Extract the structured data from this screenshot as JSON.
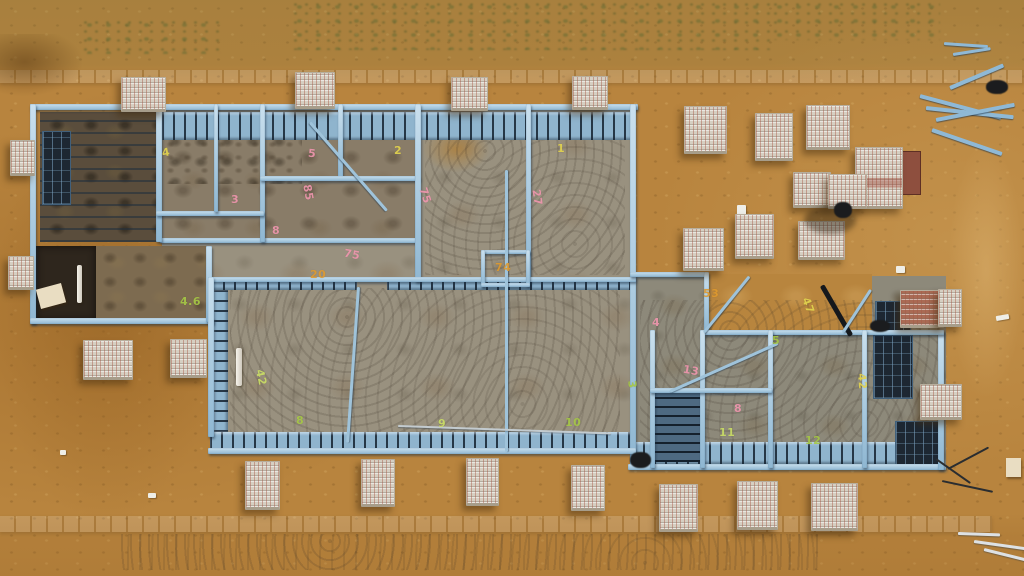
{
  "image": {
    "description": "Aerial drone photo of a residential light-gauge steel house frame erected on a concrete slab, surrounded by orange sand, brick pallets and building materials",
    "width": 1024,
    "height": 576
  },
  "palette": {
    "sand": "#b8843e",
    "kerb": "#d9be8a",
    "slab": "#99917f",
    "steel_light": "#cae0ee",
    "steel_mid": "#8fb7d2",
    "steel_dark": "#1d2732",
    "yellow": "#e3d44e",
    "pink": "#ef96ae",
    "orange": "#df9a2f",
    "green": "#a6c845",
    "lime": "#cbde66"
  },
  "scene": {
    "elements": [
      [
        "strip",
        0,
        70,
        1024,
        13,
        0,
        "kerb-strip-top"
      ],
      [
        "strip",
        0,
        516,
        992,
        16,
        0,
        "kerb-strip-bottom"
      ],
      [
        "weeds",
        290,
        0,
        480,
        50,
        0,
        "weed-patch"
      ],
      [
        "weeds",
        770,
        0,
        170,
        40,
        0,
        "weed-patch"
      ],
      [
        "weeds",
        80,
        18,
        140,
        36,
        0,
        "weed-patch"
      ],
      [
        "wetpatch",
        0,
        34,
        82,
        62,
        0,
        "wet-sand-patch"
      ],
      [
        "sand-shade",
        0,
        96,
        215,
        420,
        0,
        "sand-shade"
      ],
      [
        "sand-light",
        948,
        140,
        76,
        260,
        0,
        "sand-highlight"
      ],
      [
        "dirt-dark",
        40,
        112,
        118,
        130,
        0,
        "left-section-floor"
      ],
      [
        "slab-dirty",
        162,
        108,
        253,
        132,
        0,
        "concrete-slab"
      ],
      [
        "mottle",
        162,
        112,
        140,
        72,
        0,
        "dirt-mottle"
      ],
      [
        "slab",
        417,
        110,
        109,
        170,
        0,
        "concrete-slab"
      ],
      [
        "slab",
        530,
        110,
        102,
        170,
        0,
        "concrete-slab"
      ],
      [
        "slab",
        162,
        240,
        255,
        40,
        0,
        "concrete-slab"
      ],
      [
        "slab",
        212,
        282,
        420,
        156,
        0,
        "concrete-slab"
      ],
      [
        "slab-green",
        634,
        276,
        312,
        192,
        0,
        "concrete-slab"
      ],
      [
        "sandpatch",
        706,
        274,
        166,
        56,
        0,
        "sand-patch"
      ],
      [
        "dirt",
        95,
        246,
        114,
        74,
        0,
        "dirt-floor"
      ],
      [
        "dark-room",
        36,
        246,
        60,
        74,
        0,
        "dark-room-interior"
      ],
      [
        "sandblob",
        423,
        126,
        66,
        46,
        0,
        "sand-patch"
      ],
      [
        "track",
        230,
        288,
        390,
        145,
        0,
        "tyre-tracks"
      ],
      [
        "track",
        640,
        300,
        300,
        155,
        0,
        "tyre-tracks"
      ],
      [
        "track",
        425,
        120,
        200,
        155,
        0,
        "tyre-tracks"
      ],
      [
        "track",
        120,
        534,
        700,
        36,
        0,
        "tyre-tracks"
      ],
      [
        "joist-rows",
        40,
        112,
        118,
        130,
        0,
        "ceiling-joists"
      ],
      [
        "truss-h",
        162,
        112,
        470,
        28,
        0,
        "floor-joist-band"
      ],
      [
        "truss-h",
        212,
        277,
        145,
        13,
        0,
        "floor-joist-band"
      ],
      [
        "truss-h",
        387,
        277,
        249,
        13,
        0,
        "floor-joist-band"
      ],
      [
        "truss-h",
        210,
        432,
        424,
        20,
        0,
        "floor-joist-band"
      ],
      [
        "truss-h",
        632,
        442,
        308,
        22,
        0,
        "floor-joist-band"
      ],
      [
        "truss-v",
        212,
        290,
        16,
        142,
        0,
        "stud-band"
      ],
      [
        "truss-v-dark",
        652,
        392,
        48,
        70,
        0,
        "stud-bay"
      ],
      [
        "grid-dark",
        874,
        336,
        38,
        62,
        0,
        "dark-framing-bay"
      ],
      [
        "grid-dark",
        896,
        422,
        44,
        44,
        0,
        "dark-framing-bay"
      ],
      [
        "grid-dark",
        876,
        302,
        34,
        32,
        0,
        "dark-framing-bay"
      ],
      [
        "grid-dark",
        43,
        132,
        27,
        72,
        0,
        "window-frame"
      ],
      [
        "wall",
        30,
        104,
        608,
        6,
        0,
        "steel-frame-wall"
      ],
      [
        "wall",
        30,
        104,
        6,
        220,
        0,
        "steel-frame-wall"
      ],
      [
        "wall",
        30,
        318,
        184,
        6,
        0,
        "steel-frame-wall"
      ],
      [
        "wall",
        206,
        246,
        6,
        76,
        0,
        "steel-frame-wall"
      ],
      [
        "wall",
        160,
        238,
        258,
        5,
        0,
        "steel-frame-wall"
      ],
      [
        "wall",
        156,
        104,
        6,
        138,
        0,
        "steel-frame-wall"
      ],
      [
        "wall",
        260,
        104,
        5,
        138,
        0,
        "steel-frame-wall"
      ],
      [
        "wall",
        338,
        104,
        5,
        74,
        0,
        "steel-frame-wall"
      ],
      [
        "wall",
        260,
        176,
        160,
        5,
        0,
        "steel-frame-wall"
      ],
      [
        "wall",
        156,
        211,
        108,
        5,
        0,
        "steel-frame-wall"
      ],
      [
        "wall",
        214,
        104,
        4,
        108,
        0,
        "steel-frame-wall"
      ],
      [
        "wall",
        415,
        104,
        6,
        178,
        0,
        "steel-frame-wall"
      ],
      [
        "wall",
        526,
        104,
        5,
        178,
        0,
        "steel-frame-wall"
      ],
      [
        "wall",
        630,
        104,
        6,
        362,
        0,
        "steel-frame-wall"
      ],
      [
        "wall",
        212,
        277,
        424,
        5,
        0,
        "steel-frame-wall"
      ],
      [
        "wall",
        481,
        250,
        49,
        4,
        0,
        "closet-box-wall"
      ],
      [
        "wall",
        481,
        250,
        4,
        36,
        0,
        "closet-box-wall"
      ],
      [
        "wall",
        526,
        250,
        4,
        36,
        0,
        "closet-box-wall"
      ],
      [
        "wall",
        481,
        283,
        49,
        4,
        0,
        "closet-box-wall"
      ],
      [
        "wall",
        208,
        277,
        6,
        160,
        0,
        "steel-frame-wall"
      ],
      [
        "wall",
        208,
        448,
        428,
        6,
        0,
        "steel-frame-wall"
      ],
      [
        "wall",
        628,
        464,
        318,
        6,
        0,
        "steel-frame-wall"
      ],
      [
        "wall",
        938,
        330,
        6,
        140,
        0,
        "steel-frame-wall"
      ],
      [
        "wall",
        630,
        272,
        78,
        5,
        0,
        "steel-frame-wall"
      ],
      [
        "wall",
        704,
        272,
        5,
        60,
        0,
        "steel-frame-wall"
      ],
      [
        "wall",
        704,
        330,
        240,
        5,
        0,
        "steel-frame-wall"
      ],
      [
        "wall",
        650,
        330,
        5,
        138,
        0,
        "steel-frame-wall"
      ],
      [
        "wall",
        700,
        330,
        5,
        138,
        0,
        "steel-frame-wall"
      ],
      [
        "wall",
        768,
        330,
        5,
        138,
        0,
        "steel-frame-wall"
      ],
      [
        "wall",
        650,
        388,
        122,
        5,
        0,
        "steel-frame-wall"
      ],
      [
        "wall",
        862,
        330,
        5,
        138,
        0,
        "steel-frame-wall"
      ],
      [
        "diag",
        310,
        121,
        117,
        3,
        49,
        "steel-brace"
      ],
      [
        "pole-v",
        505,
        170,
        3,
        282,
        0,
        "steel-brace"
      ],
      [
        "pole-v",
        357,
        287,
        3,
        156,
        4,
        "steel-brace"
      ],
      [
        "diag-grey",
        398,
        425,
        213,
        2,
        2,
        "screed-rail"
      ],
      [
        "diag",
        670,
        390,
        118,
        3,
        -24,
        "steel-brace"
      ],
      [
        "diag",
        704,
        331,
        72,
        3,
        -51,
        "steel-brace"
      ],
      [
        "diag-dark",
        822,
        283,
        58,
        5,
        60,
        "dark-brace"
      ],
      [
        "diag",
        843,
        331,
        51,
        3,
        -57,
        "steel-brace"
      ],
      [
        "pipe",
        77,
        265,
        5,
        38,
        0,
        "pvc-pipe"
      ],
      [
        "pipe",
        236,
        348,
        6,
        38,
        0,
        "pvc-pipe"
      ],
      [
        "board",
        38,
        286,
        26,
        20,
        -15,
        "board-sheet"
      ],
      [
        "board-red",
        901,
        151,
        18,
        42,
        0,
        "red-panel"
      ],
      [
        "white-bit",
        896,
        266,
        9,
        7,
        0,
        "white-debris"
      ],
      [
        "white-bit",
        996,
        315,
        13,
        5,
        -10,
        "white-debris"
      ],
      [
        "board",
        1006,
        458,
        15,
        19,
        0,
        "board-sheet"
      ],
      [
        "white-bit",
        737,
        205,
        9,
        12,
        0,
        "plastic-wrap"
      ],
      [
        "white-bit",
        60,
        450,
        6,
        5,
        0,
        "white-debris"
      ],
      [
        "white-bit",
        148,
        493,
        8,
        5,
        0,
        "white-debris"
      ],
      [
        "pallet",
        121,
        77,
        43,
        31,
        0,
        "brick-pallet"
      ],
      [
        "pallet",
        295,
        72,
        38,
        33,
        0,
        "brick-pallet"
      ],
      [
        "pallet",
        451,
        77,
        35,
        30,
        0,
        "brick-pallet"
      ],
      [
        "pallet",
        572,
        76,
        34,
        30,
        0,
        "brick-pallet"
      ],
      [
        "pallet",
        684,
        106,
        41,
        44,
        0,
        "brick-pallet"
      ],
      [
        "pallet",
        755,
        113,
        36,
        44,
        0,
        "brick-pallet"
      ],
      [
        "pallet",
        806,
        105,
        42,
        41,
        0,
        "brick-pallet"
      ],
      [
        "pallet-tall",
        855,
        147,
        46,
        58,
        0,
        "brick-pallet-stacked"
      ],
      [
        "pallet",
        793,
        172,
        36,
        32,
        0,
        "brick-pallet"
      ],
      [
        "pallet",
        828,
        174,
        37,
        31,
        0,
        "brick-pallet"
      ],
      [
        "pallet",
        798,
        221,
        45,
        35,
        0,
        "brick-pallet"
      ],
      [
        "pallet",
        683,
        228,
        39,
        39,
        0,
        "brick-pallet"
      ],
      [
        "pallet",
        735,
        214,
        37,
        41,
        0,
        "brick-pallet"
      ],
      [
        "pallet",
        10,
        140,
        23,
        32,
        0,
        "brick-pallet"
      ],
      [
        "pallet",
        8,
        256,
        24,
        30,
        0,
        "brick-pallet"
      ],
      [
        "pallet",
        83,
        340,
        48,
        36,
        0,
        "brick-pallet"
      ],
      [
        "pallet",
        170,
        339,
        35,
        35,
        0,
        "brick-pallet"
      ],
      [
        "pallet",
        245,
        461,
        33,
        45,
        0,
        "brick-pallet"
      ],
      [
        "pallet",
        361,
        459,
        32,
        44,
        0,
        "brick-pallet"
      ],
      [
        "pallet",
        466,
        458,
        31,
        44,
        0,
        "brick-pallet"
      ],
      [
        "pallet",
        571,
        465,
        32,
        42,
        0,
        "brick-pallet"
      ],
      [
        "pallet",
        659,
        484,
        37,
        44,
        0,
        "brick-pallet"
      ],
      [
        "pallet",
        737,
        481,
        39,
        45,
        0,
        "brick-pallet"
      ],
      [
        "pallet",
        811,
        483,
        45,
        44,
        0,
        "brick-pallet"
      ],
      [
        "pallet",
        920,
        384,
        40,
        32,
        0,
        "brick-pallet"
      ],
      [
        "pallet-red",
        900,
        290,
        42,
        34,
        0,
        "brick-stack"
      ],
      [
        "pallet",
        938,
        289,
        22,
        34,
        0,
        "brick-pallet"
      ],
      [
        "shadow",
        804,
        206,
        52,
        28,
        0,
        "shadow"
      ],
      [
        "blob-dark",
        834,
        202,
        18,
        16,
        0,
        "worker-figure"
      ],
      [
        "blob-dark",
        630,
        452,
        21,
        16,
        0,
        "dark-object"
      ],
      [
        "blob-dark",
        986,
        80,
        22,
        14,
        0,
        "dark-object"
      ],
      [
        "blob-dark",
        870,
        320,
        20,
        12,
        0,
        "dark-object"
      ],
      [
        "bar-dark",
        936,
        458,
        42,
        2,
        35,
        "wire-debris"
      ],
      [
        "bar-dark",
        948,
        468,
        46,
        2,
        -28,
        "wire-debris"
      ],
      [
        "bar-dark",
        942,
        480,
        52,
        2,
        12,
        "wire-debris"
      ],
      [
        "bar-blue",
        920,
        94,
        84,
        4,
        15,
        "steel-offcut"
      ],
      [
        "bar-blue",
        926,
        106,
        88,
        4,
        6,
        "steel-offcut"
      ],
      [
        "bar-blue",
        936,
        118,
        80,
        4,
        -11,
        "steel-offcut"
      ],
      [
        "bar-blue",
        932,
        128,
        74,
        4,
        19,
        "steel-offcut"
      ],
      [
        "bar-blue",
        950,
        86,
        58,
        4,
        -23,
        "steel-offcut"
      ],
      [
        "bar-blue",
        944,
        42,
        44,
        3,
        4,
        "steel-offcut"
      ],
      [
        "bar-blue",
        953,
        53,
        38,
        3,
        -9,
        "steel-offcut"
      ],
      [
        "bar-grey",
        974,
        540,
        56,
        3,
        8,
        "metal-offcut"
      ],
      [
        "bar-grey",
        984,
        548,
        46,
        3,
        14,
        "metal-offcut"
      ],
      [
        "bar-grey",
        958,
        532,
        42,
        3,
        2,
        "metal-offcut"
      ]
    ],
    "markings": [
      [
        "4",
        162,
        146,
        "yellow",
        -10
      ],
      [
        "5",
        308,
        147,
        "pink",
        5
      ],
      [
        "2",
        394,
        144,
        "yellow",
        0
      ],
      [
        "1",
        557,
        142,
        "yellow",
        0
      ],
      [
        "85",
        300,
        186,
        "pink",
        80
      ],
      [
        "75",
        417,
        189,
        "pink",
        72
      ],
      [
        "27",
        529,
        191,
        "pink",
        82
      ],
      [
        "3",
        231,
        193,
        "pink",
        0
      ],
      [
        "8",
        272,
        224,
        "pink",
        0
      ],
      [
        "75",
        344,
        248,
        "pink",
        10
      ],
      [
        "20",
        310,
        268,
        "orange",
        0
      ],
      [
        "74",
        495,
        261,
        "orange",
        0
      ],
      [
        "4.6",
        180,
        295,
        "green",
        0
      ],
      [
        "42",
        253,
        371,
        "lime",
        78
      ],
      [
        "8",
        296,
        414,
        "green",
        0
      ],
      [
        "9",
        438,
        417,
        "lime",
        0
      ],
      [
        "10",
        565,
        416,
        "green",
        0
      ],
      [
        "53",
        703,
        287,
        "orange",
        0
      ],
      [
        "47",
        800,
        299,
        "yellow",
        70
      ],
      [
        "4",
        652,
        316,
        "pink",
        0
      ],
      [
        "5",
        772,
        334,
        "green",
        0
      ],
      [
        "3",
        628,
        378,
        "green",
        85
      ],
      [
        "13",
        683,
        364,
        "pink",
        10
      ],
      [
        "8",
        734,
        402,
        "pink",
        0
      ],
      [
        "11",
        719,
        426,
        "lime",
        0
      ],
      [
        "12",
        805,
        434,
        "green",
        0
      ],
      [
        "42",
        854,
        375,
        "yellow",
        85
      ]
    ]
  }
}
